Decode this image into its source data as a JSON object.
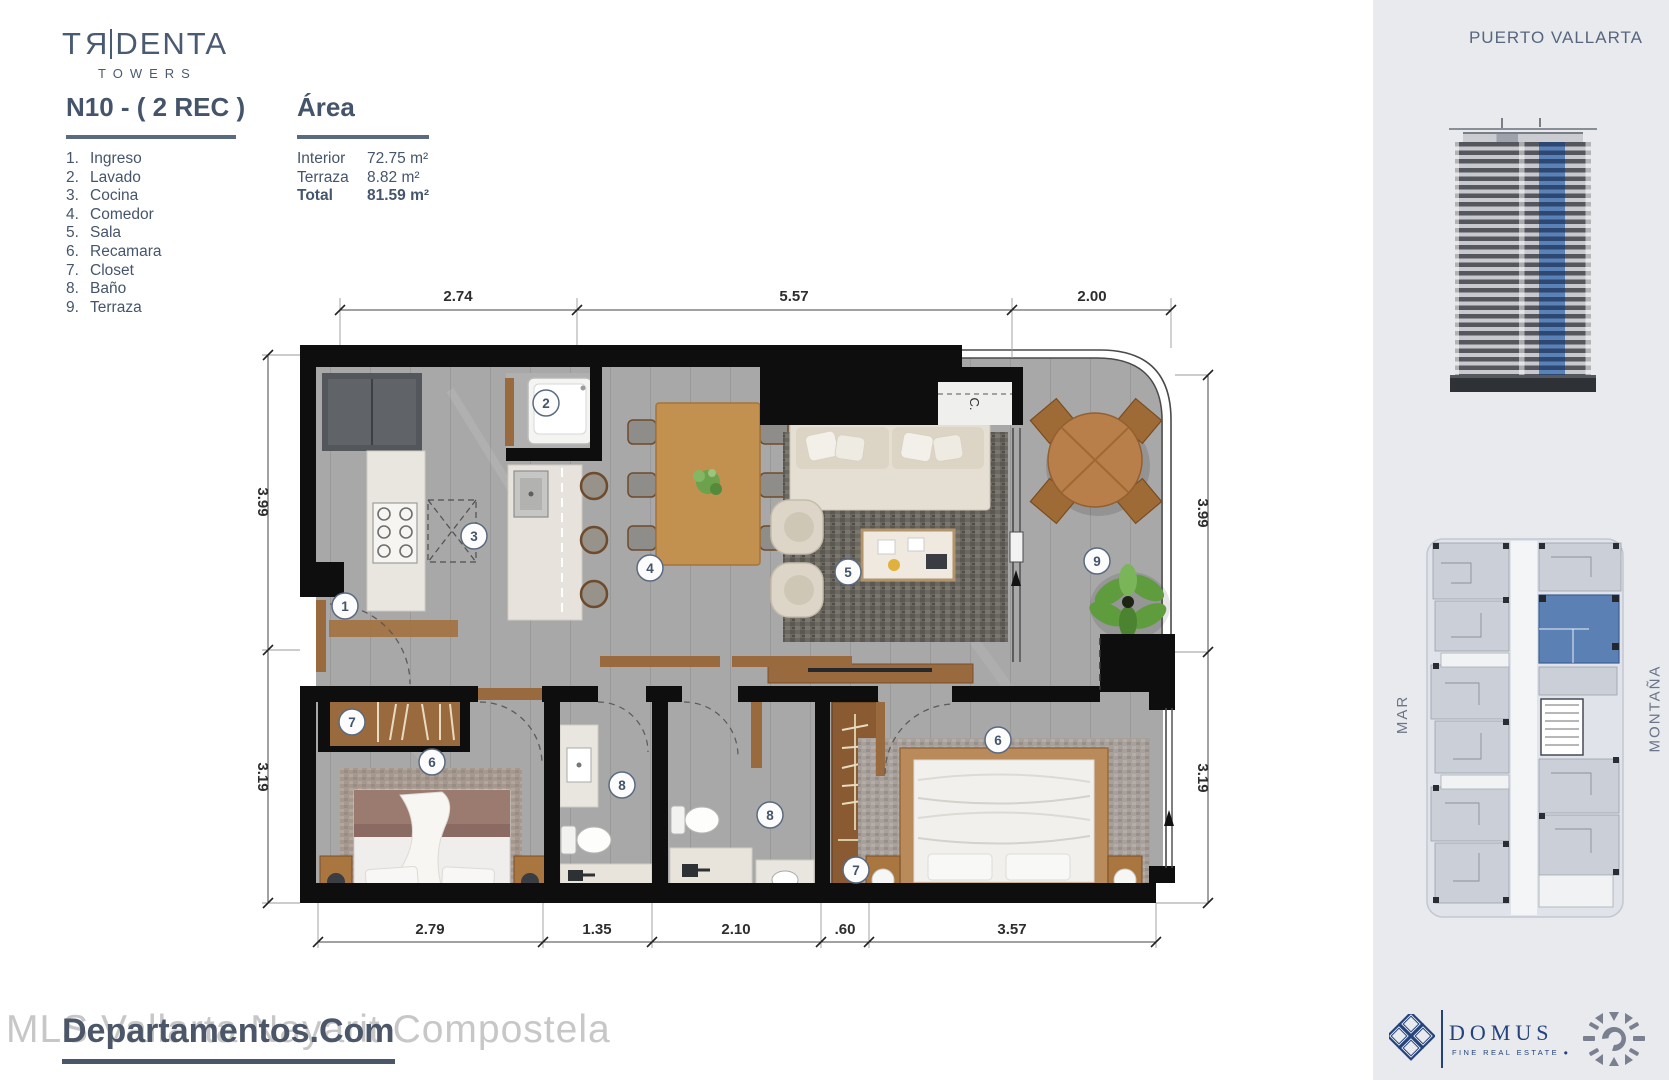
{
  "header": {
    "logo_t": "T",
    "logo_r": "R",
    "logo_rest": "DENTA",
    "logo_sub": "TOWERS"
  },
  "unit": {
    "title": "N10 - ( 2 REC )"
  },
  "legend": [
    {
      "num": "1.",
      "label": "Ingreso"
    },
    {
      "num": "2.",
      "label": "Lavado"
    },
    {
      "num": "3.",
      "label": "Cocina"
    },
    {
      "num": "4.",
      "label": "Comedor"
    },
    {
      "num": "5.",
      "label": "Sala"
    },
    {
      "num": "6.",
      "label": "Recamara"
    },
    {
      "num": "7.",
      "label": "Closet"
    },
    {
      "num": "8.",
      "label": "Baño"
    },
    {
      "num": "9.",
      "label": "Terraza"
    }
  ],
  "area": {
    "title": "Área",
    "rows": [
      {
        "label": "Interior",
        "value": "72.75 m²"
      },
      {
        "label": "Terraza",
        "value": "8.82 m²"
      }
    ],
    "total_label": "Total",
    "total_value": "81.59 m²"
  },
  "plan": {
    "dims_top": [
      "2.74",
      "5.57",
      "2.00"
    ],
    "dims_left": [
      "3.99",
      "3.19"
    ],
    "dims_right": [
      "3.99",
      "3.19"
    ],
    "dims_bottom": [
      "2.79",
      "1.35",
      "2.10",
      ".60",
      "3.57"
    ],
    "closet_label": "C.",
    "markers": {
      "ingreso": "1",
      "lavado": "2",
      "cocina": "3",
      "comedor": "4",
      "sala": "5",
      "recamara_1": "6",
      "closet_1": "7",
      "bano_1": "8",
      "bano_2": "8",
      "closet_2": "7",
      "recamara_2": "6",
      "terraza": "9"
    }
  },
  "sidebar": {
    "location": "PUERTO VALLARTA",
    "label_mar": "MAR",
    "label_montana": "MONTAÑA",
    "domus_name": "DOMUS",
    "domus_tagline": "FINE REAL ESTATE   ●"
  },
  "watermark": {
    "light": "MLS Vallarta Nayarit Compostela",
    "dark": "Departamentos.Com"
  },
  "colors": {
    "accent": "#44546a",
    "sidebar_bg": "#e8eaee",
    "unit_blue": "#5b80b4",
    "domus_navy": "#24437c"
  }
}
